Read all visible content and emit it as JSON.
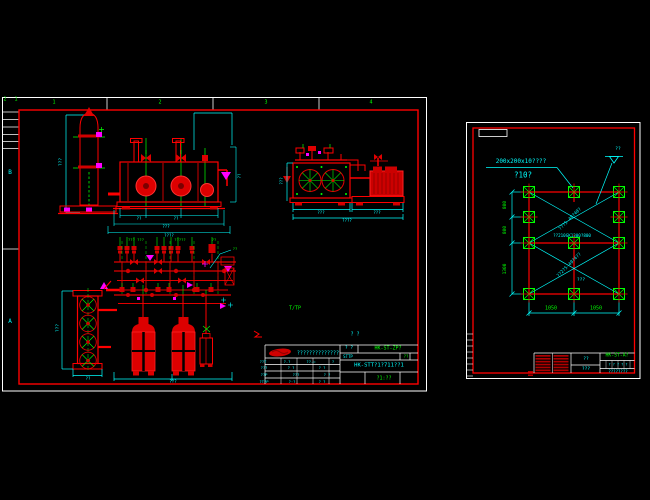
{
  "colors": {
    "bg": "#000000",
    "white": "#ffffff",
    "red": "#ff0000",
    "dark_red": "#cc0000",
    "green": "#00ff00",
    "cyan": "#00ffff",
    "magenta": "#ff00ff"
  },
  "left_sheet": {
    "annotations": [
      {
        "name": "corner-zone-text-1",
        "text": "2",
        "x": 5,
        "y": 100,
        "size": 5,
        "color": "green"
      },
      {
        "name": "corner-zone-text-2",
        "text": "1",
        "x": 16,
        "y": 100,
        "size": 5,
        "color": "green"
      },
      {
        "name": "top-zone-1",
        "text": "1",
        "x": 54,
        "y": 103,
        "size": 5,
        "color": "green"
      },
      {
        "name": "top-zone-2",
        "text": "2",
        "x": 160,
        "y": 103,
        "size": 5,
        "color": "green"
      },
      {
        "name": "top-zone-3",
        "text": "3",
        "x": 266,
        "y": 103,
        "size": 5,
        "color": "green"
      },
      {
        "name": "top-zone-4",
        "text": "4",
        "x": 371,
        "y": 103,
        "size": 5,
        "color": "green"
      },
      {
        "name": "left-zone-b",
        "text": "B",
        "x": 10,
        "y": 173,
        "size": 6,
        "color": "cyan"
      },
      {
        "name": "left-zone-a",
        "text": "A",
        "x": 10,
        "y": 322,
        "size": 6,
        "color": "cyan"
      },
      {
        "name": "vessel-dim",
        "text": "???",
        "x": 62,
        "y": 162,
        "size": 4.5,
        "color": "cyan",
        "rot": -90
      },
      {
        "name": "skid-dim-1",
        "text": "??",
        "x": 139,
        "y": 219,
        "size": 4,
        "color": "cyan"
      },
      {
        "name": "skid-dim-2",
        "text": "??",
        "x": 176,
        "y": 219,
        "size": 4,
        "color": "cyan"
      },
      {
        "name": "skid-dim-3",
        "text": "???",
        "x": 166,
        "y": 227,
        "size": 4,
        "color": "cyan"
      },
      {
        "name": "skid-dim-total",
        "text": "????",
        "x": 169,
        "y": 236,
        "size": 4,
        "color": "cyan"
      },
      {
        "name": "skid-dim-right",
        "text": "??",
        "x": 240,
        "y": 176,
        "size": 4,
        "color": "cyan",
        "rot": -90
      },
      {
        "name": "cond-dim-1",
        "text": "???",
        "x": 321,
        "y": 213,
        "size": 4,
        "color": "cyan"
      },
      {
        "name": "cond-dim-2",
        "text": "???",
        "x": 377,
        "y": 213,
        "size": 4,
        "color": "cyan"
      },
      {
        "name": "cond-dim-total",
        "text": "????",
        "x": 347,
        "y": 221,
        "size": 4,
        "color": "cyan"
      },
      {
        "name": "cond-dim-left",
        "text": "???",
        "x": 282,
        "y": 181,
        "size": 4,
        "color": "cyan",
        "rot": -90
      },
      {
        "name": "plan-label-1",
        "text": "??? ???",
        "x": 136,
        "y": 240,
        "size": 3.8,
        "color": "green"
      },
      {
        "name": "plan-label-2",
        "text": "?????",
        "x": 180,
        "y": 240,
        "size": 3.8,
        "color": "green"
      },
      {
        "name": "plan-label-3",
        "text": "??",
        "x": 214,
        "y": 240,
        "size": 3.8,
        "color": "green"
      },
      {
        "name": "plan-leader-label",
        "text": "??",
        "x": 235,
        "y": 249,
        "size": 3.8,
        "color": "green"
      },
      {
        "name": "tp-note",
        "text": "T/TP",
        "x": 295,
        "y": 309,
        "size": 5,
        "color": "green"
      },
      {
        "name": "bank-dim-left",
        "text": "???",
        "x": 59,
        "y": 328,
        "size": 4.5,
        "color": "cyan",
        "rot": -90
      },
      {
        "name": "bank-dim-bottom",
        "text": "??",
        "x": 88,
        "y": 379,
        "size": 4,
        "color": "cyan"
      },
      {
        "name": "tank-dim-bottom",
        "text": "???",
        "x": 173,
        "y": 382,
        "size": 4,
        "color": "cyan"
      },
      {
        "name": "tb-above-label",
        "text": "? ?",
        "x": 355,
        "y": 335,
        "size": 5,
        "color": "cyan"
      },
      {
        "name": "tb-company",
        "text": "??????????????",
        "x": 318,
        "y": 353.5,
        "size": 5,
        "color": "cyan"
      },
      {
        "name": "tb-no-label",
        "text": "? ?",
        "x": 349,
        "y": 349,
        "size": 4.5,
        "color": "cyan"
      },
      {
        "name": "tb-code",
        "text": "HK-ST-ZP?",
        "x": 388,
        "y": 349,
        "size": 5,
        "color": "green"
      },
      {
        "name": "tb-row2-left",
        "text": "STTP",
        "x": 348,
        "y": 356.5,
        "size": 4,
        "color": "cyan"
      },
      {
        "name": "tb-row2-right",
        "text": "??",
        "x": 406,
        "y": 356.5,
        "size": 4,
        "color": "green"
      },
      {
        "name": "tb-main-code",
        "text": "HK-STT?1?711??1",
        "x": 379,
        "y": 366,
        "size": 5.5,
        "color": "cyan"
      },
      {
        "name": "tb-scale",
        "text": "?1:??",
        "x": 384,
        "y": 378.5,
        "size": 5,
        "color": "green"
      },
      {
        "name": "tb-cell-1",
        "text": "??T",
        "x": 263,
        "y": 361.5,
        "size": 3.8,
        "color": "cyan"
      },
      {
        "name": "tb-cell-2",
        "text": "?-?",
        "x": 287,
        "y": 361.5,
        "size": 3.8,
        "color": "cyan"
      },
      {
        "name": "tb-cell-3",
        "text": "??-=",
        "x": 311,
        "y": 361.5,
        "size": 3.8,
        "color": "cyan"
      },
      {
        "name": "tb-cell-4",
        "text": "?",
        "x": 333,
        "y": 361.5,
        "size": 3.8,
        "color": "cyan"
      },
      {
        "name": "tb-cell-5",
        "text": "???",
        "x": 264,
        "y": 368,
        "size": 3.8,
        "color": "cyan"
      },
      {
        "name": "tb-cell-6",
        "text": "? ?",
        "x": 291,
        "y": 368,
        "size": 3.8,
        "color": "cyan"
      },
      {
        "name": "tb-cell-7",
        "text": "? ?",
        "x": 322,
        "y": 368,
        "size": 3.8,
        "color": "cyan"
      },
      {
        "name": "tb-cell-8",
        "text": "??P",
        "x": 264,
        "y": 374.5,
        "size": 3.8,
        "color": "cyan"
      },
      {
        "name": "tb-cell-9",
        "text": "???",
        "x": 296,
        "y": 374.5,
        "size": 3.8,
        "color": "cyan"
      },
      {
        "name": "tb-cell-10",
        "text": "? ?",
        "x": 327,
        "y": 374.5,
        "size": 3.8,
        "color": "cyan"
      },
      {
        "name": "tb-cell-11",
        "text": "?T?P",
        "x": 264,
        "y": 381.5,
        "size": 3.8,
        "color": "cyan"
      },
      {
        "name": "tb-cell-12",
        "text": "?·?",
        "x": 292,
        "y": 381.5,
        "size": 3.8,
        "color": "cyan"
      },
      {
        "name": "tb-cell-13",
        "text": "? ?",
        "x": 322,
        "y": 381.5,
        "size": 3.8,
        "color": "cyan"
      }
    ]
  },
  "right_sheet": {
    "annotations": [
      {
        "name": "note-bolt-spec",
        "text": "200x200x10????",
        "x": 521,
        "y": 162,
        "size": 6,
        "color": "cyan"
      },
      {
        "name": "note-dia",
        "text": "?10?",
        "x": 523,
        "y": 175,
        "size": 7.5,
        "color": "cyan"
      },
      {
        "name": "elev-text",
        "text": "??",
        "x": 618,
        "y": 150,
        "size": 4.5,
        "color": "cyan"
      },
      {
        "name": "dim-800-a",
        "text": "800",
        "x": 506,
        "y": 204.5,
        "size": 4.5,
        "color": "green",
        "rot": -90
      },
      {
        "name": "dim-800-b",
        "text": "800",
        "x": 506,
        "y": 230,
        "size": 4.5,
        "color": "green",
        "rot": -90
      },
      {
        "name": "dim-1300",
        "text": "1300",
        "x": 506,
        "y": 268.5,
        "size": 4.5,
        "color": "green",
        "rot": -90
      },
      {
        "name": "dim-1050-a",
        "text": "1050",
        "x": 551,
        "y": 309,
        "size": 5,
        "color": "green"
      },
      {
        "name": "dim-1050-b",
        "text": "1050",
        "x": 596,
        "y": 309,
        "size": 5,
        "color": "green"
      },
      {
        "name": "diag-note-1",
        "text": "???5-40?40?",
        "x": 571,
        "y": 220,
        "size": 4.5,
        "color": "cyan",
        "rot": -45
      },
      {
        "name": "diag-note-2",
        "text": "??2?5-40?4??",
        "x": 570,
        "y": 266,
        "size": 4.5,
        "color": "cyan",
        "rot": -45
      },
      {
        "name": "channel-note",
        "text": "??210GK1300?800",
        "x": 572,
        "y": 236,
        "size": 4.2,
        "color": "cyan"
      },
      {
        "name": "plan-caption",
        "text": "???",
        "x": 581,
        "y": 281,
        "size": 4.5,
        "color": "cyan"
      },
      {
        "name": "rtb-code",
        "text": "HK-ST-A?",
        "x": 617,
        "y": 357,
        "size": 4.8,
        "color": "green"
      },
      {
        "name": "rtb-mid-1",
        "text": "??",
        "x": 586,
        "y": 359.5,
        "size": 4.5,
        "color": "cyan"
      },
      {
        "name": "rtb-mid-2",
        "text": "???",
        "x": 586,
        "y": 370,
        "size": 4.5,
        "color": "cyan"
      },
      {
        "name": "rtb-cells",
        "text": "? ? ? ? ?",
        "x": 618,
        "y": 364.5,
        "size": 3.5,
        "color": "cyan"
      },
      {
        "name": "rtb-bottom",
        "text": "????????",
        "x": 618,
        "y": 371.5,
        "size": 4,
        "color": "cyan"
      }
    ]
  }
}
